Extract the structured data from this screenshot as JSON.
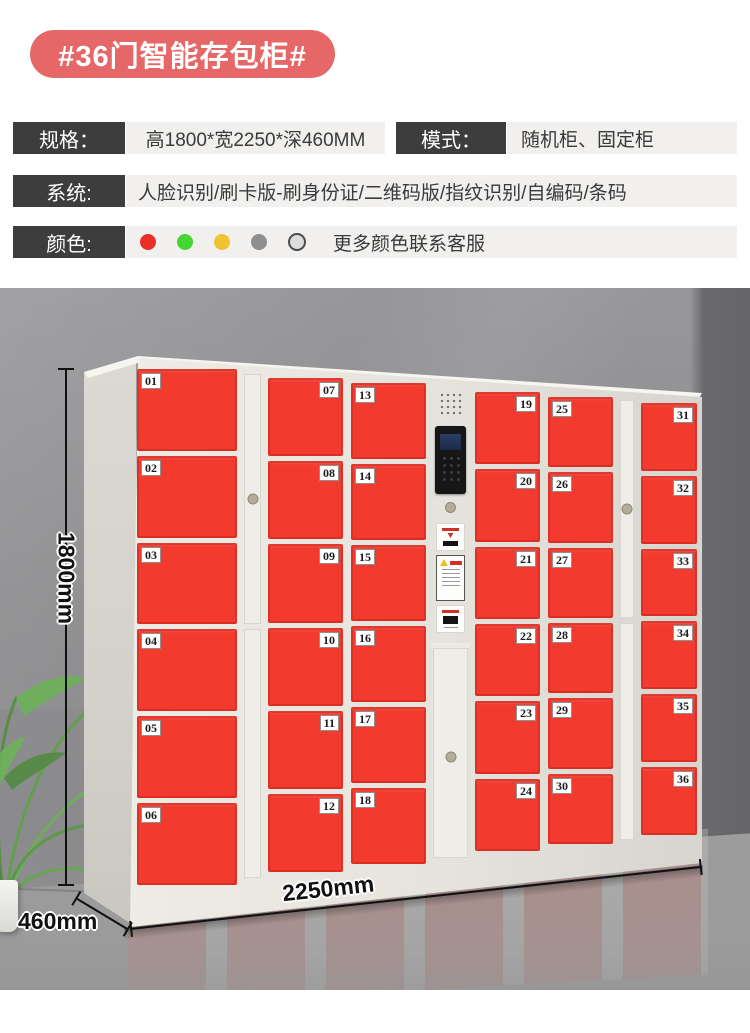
{
  "title": "#36门智能存包柜#",
  "specs": {
    "row1": {
      "label1": "规格：",
      "value1": "高1800*宽2250*深460MM",
      "label2": "模式：",
      "value2": "随机柜、固定柜"
    },
    "row2": {
      "label": "系统:",
      "value": "人脸识别/刷卡版-刷身份证/二维码版/指纹识别/自编码/条码"
    },
    "row3": {
      "label": "颜色:",
      "note": "更多颜色联系客服",
      "swatches": [
        {
          "name": "red",
          "hex": "#e83028"
        },
        {
          "name": "green",
          "hex": "#46d634"
        },
        {
          "name": "yellow",
          "hex": "#f0c431"
        },
        {
          "name": "gray",
          "hex": "#8f8f8f"
        },
        {
          "name": "more-custom",
          "hex": "#dcdcdc",
          "outline": "#4a4a4a"
        }
      ]
    }
  },
  "dimensions": {
    "height": "1800mm",
    "width": "2250mm",
    "depth": "460mm"
  },
  "locker": {
    "door_count": 36,
    "columns": [
      {
        "type": "doors",
        "tag_side": "left",
        "doors": [
          "01",
          "02",
          "03",
          "04",
          "05",
          "06"
        ]
      },
      {
        "type": "strip"
      },
      {
        "type": "doors",
        "tag_side": "right",
        "doors": [
          "07",
          "08",
          "09",
          "10",
          "11",
          "12"
        ]
      },
      {
        "type": "doors",
        "tag_side": "left",
        "doors": [
          "13",
          "14",
          "15",
          "16",
          "17",
          "18"
        ]
      },
      {
        "type": "tower"
      },
      {
        "type": "doors",
        "tag_side": "right",
        "doors": [
          "19",
          "20",
          "21",
          "22",
          "23",
          "24"
        ]
      },
      {
        "type": "doors",
        "tag_side": "left",
        "doors": [
          "25",
          "26",
          "27",
          "28",
          "29",
          "30"
        ]
      },
      {
        "type": "strip"
      },
      {
        "type": "doors",
        "tag_side": "right",
        "doors": [
          "31",
          "32",
          "33",
          "34",
          "35",
          "36"
        ]
      }
    ]
  },
  "colors": {
    "badge": "#e56767",
    "door_red": "#f23a2e",
    "spec_label_bg": "#3d3d3d",
    "spec_value_bg": "#f1f0ee",
    "wall": "#8d8d8f",
    "floor": "#a2a1a0",
    "cabinet_frame": "#eceae3"
  }
}
